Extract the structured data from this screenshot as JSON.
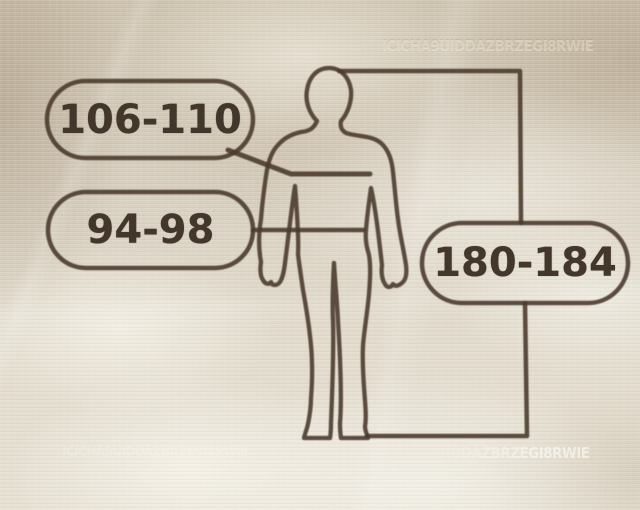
{
  "diagram": {
    "kind": "clothing-size-guide",
    "figure": "human-body-outline",
    "measurements": [
      {
        "id": "chest",
        "target": "chest",
        "value": "106-110"
      },
      {
        "id": "waist",
        "target": "waist",
        "value": "94-98"
      },
      {
        "id": "height",
        "target": "height",
        "value": "180-184"
      }
    ]
  },
  "watermark": {
    "text": "ICICHA9UIDDAZBRZEGI8RWIE"
  },
  "colors": {
    "ink": "#4a3b2d",
    "background_base": "#d8cfbf",
    "highlight": "#f4f0e4",
    "shadow_tan": "#b3a48e"
  }
}
